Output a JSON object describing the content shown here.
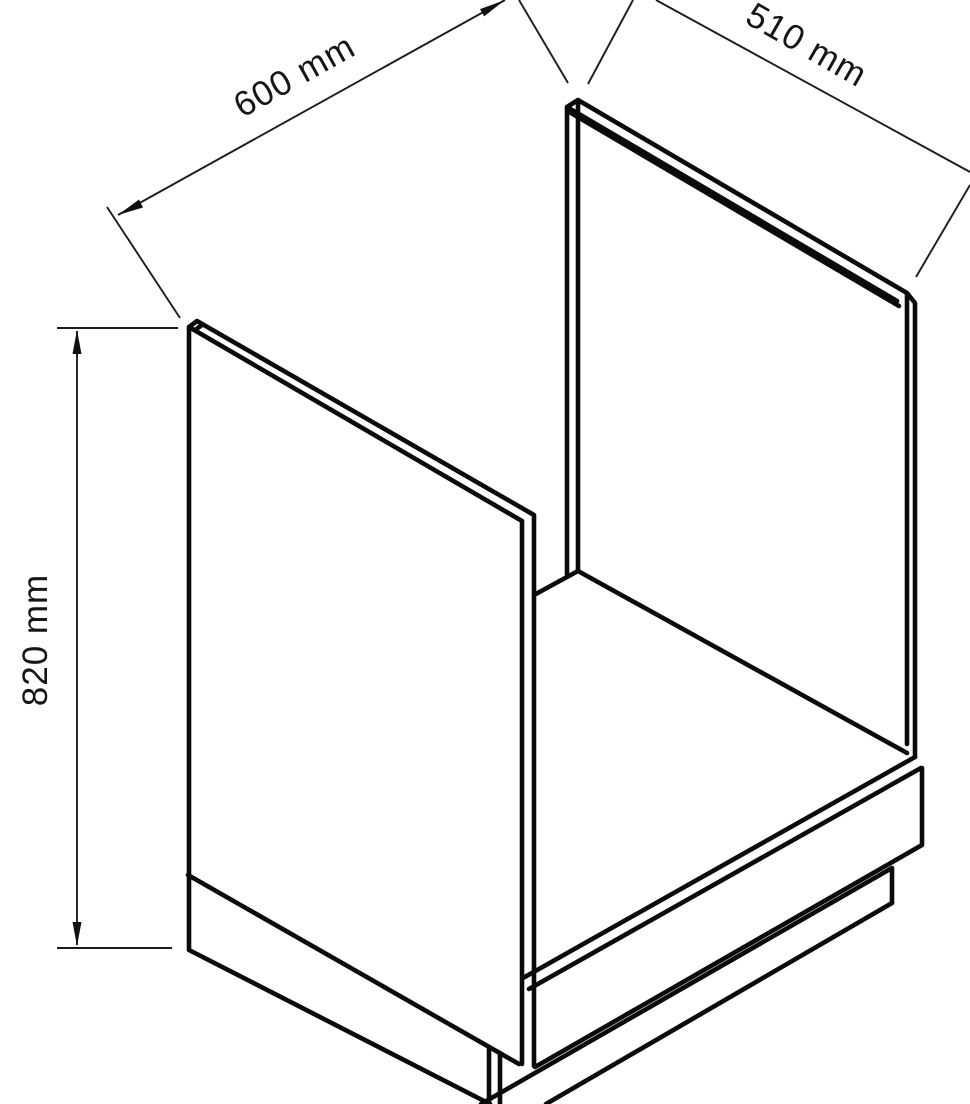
{
  "figure": {
    "kind": "isometric technical line drawing",
    "subject": "oven housing base cabinet carcass",
    "background_color": "#ffffff",
    "line_color": "#0b0b0b",
    "dimension_line_color": "#1c1c1c",
    "text_color": "#161616"
  },
  "dimensions": {
    "width": {
      "label": "600 mm",
      "value": 600,
      "unit": "mm"
    },
    "depth": {
      "label": "510 mm",
      "value": 510,
      "unit": "mm"
    },
    "height": {
      "label": "820 mm",
      "value": 820,
      "unit": "mm"
    }
  }
}
